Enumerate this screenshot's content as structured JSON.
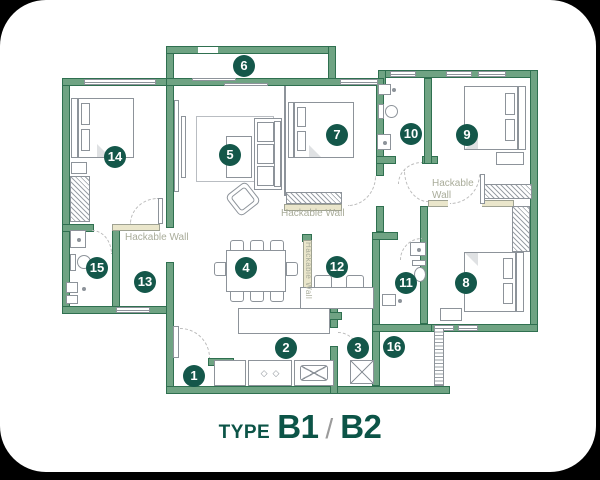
{
  "title": {
    "prefix": "TYPE",
    "plan_a": "B1",
    "separator": "/",
    "plan_b": "B2"
  },
  "labels": {
    "hackable_wall": "Hackable Wall"
  },
  "rooms": [
    {
      "number": "1"
    },
    {
      "number": "2"
    },
    {
      "number": "3"
    },
    {
      "number": "4"
    },
    {
      "number": "5"
    },
    {
      "number": "6"
    },
    {
      "number": "7"
    },
    {
      "number": "8"
    },
    {
      "number": "9"
    },
    {
      "number": "10"
    },
    {
      "number": "11"
    },
    {
      "number": "12"
    },
    {
      "number": "13"
    },
    {
      "number": "14"
    },
    {
      "number": "15"
    },
    {
      "number": "16"
    }
  ],
  "colors": {
    "wall_fill": "#6FA383",
    "wall_edge": "#2F7050",
    "badge_bg": "#14574A",
    "badge_text": "#FFFFFF",
    "hackable_fill": "#EAE6CB",
    "hackable_edge": "#9FA292",
    "label_text": "#A9AC9A",
    "furniture_line": "#8D939A",
    "title_green": "#0C5447",
    "slash_gray": "#9B9B9B",
    "card_bg": "#FFFFFF",
    "page_bg": "#000000"
  }
}
